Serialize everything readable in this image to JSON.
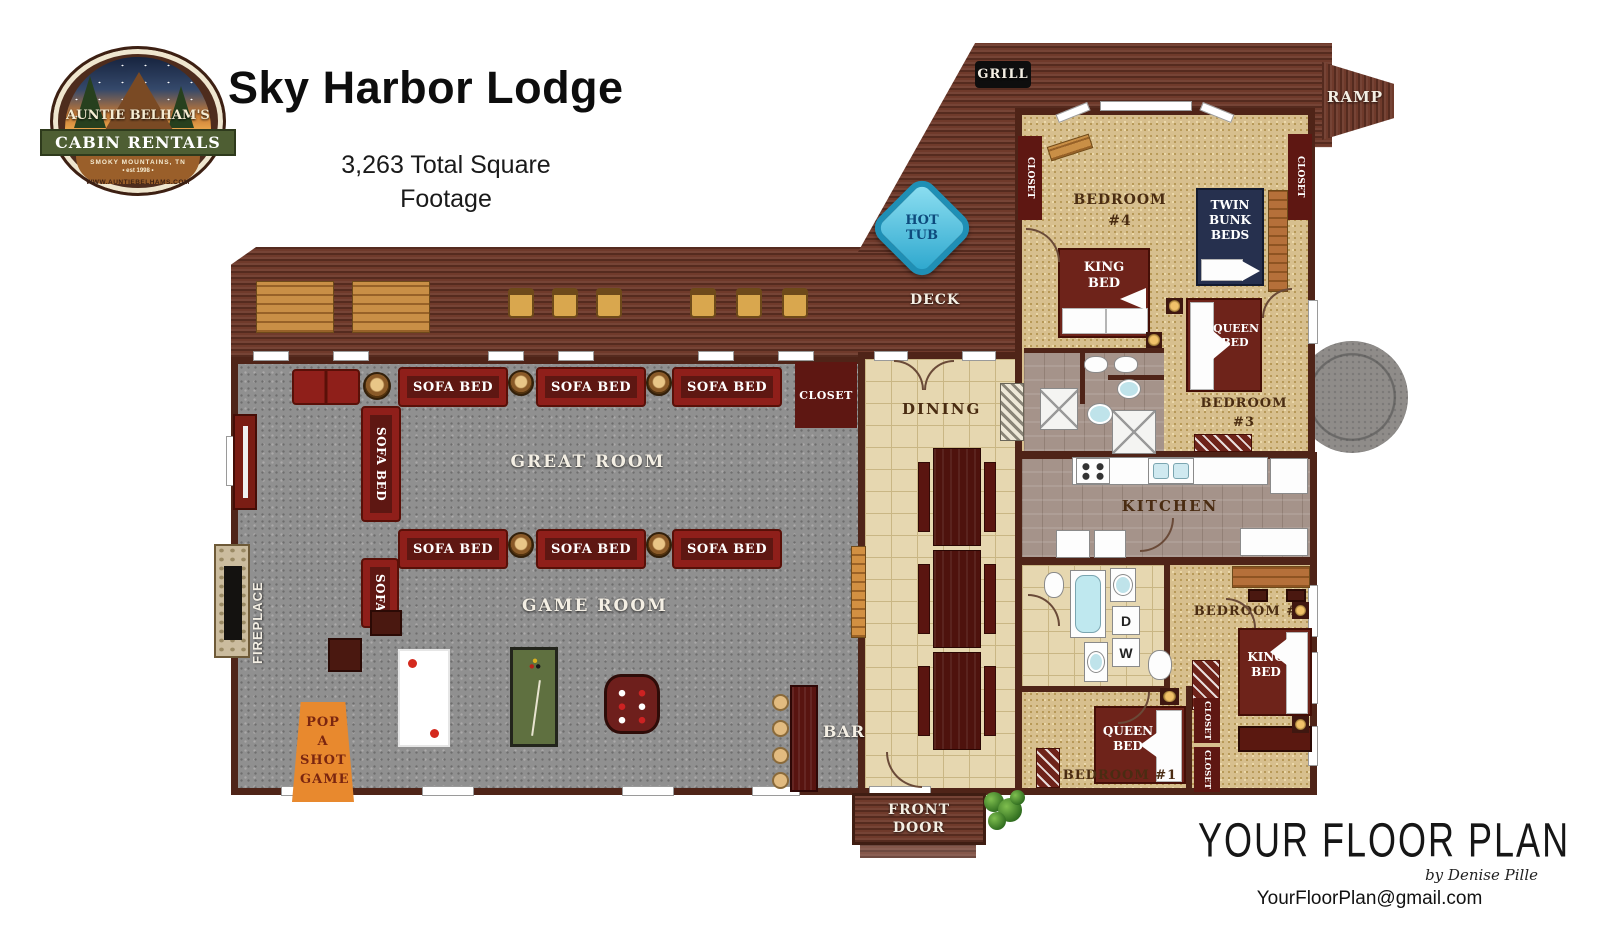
{
  "header": {
    "logo": {
      "arc_top": "AUNTIE BELHAM'S",
      "ribbon": "CABIN RENTALS",
      "sub_line": "SMOKY MOUNTAINS, TN",
      "est_line": "• est 1998 •",
      "arc_bottom": "WWW.AUNTIEBELHAMS.COM"
    },
    "title": "Sky Harbor Lodge",
    "sqft_line1": "3,263 Total Square",
    "sqft_line2": "Footage"
  },
  "deck": {
    "grill": "GRILL",
    "ramp": "RAMP",
    "hot_tub": "HOT TUB",
    "label": "DECK"
  },
  "great_room": {
    "label": "GREAT ROOM",
    "closet": "CLOSET",
    "fireplace": "FIREPLACE",
    "sofa_bed": "SOFA BED",
    "sofa": "SOFA"
  },
  "game_room": {
    "label": "GAME ROOM",
    "pop_a_shot": "POP A SHOT GAME",
    "bar": "BAR"
  },
  "dining": {
    "label": "DINING"
  },
  "kitchen": {
    "label": "KITCHEN"
  },
  "bedroom4": {
    "label": "BEDROOM #4",
    "king_bed": "KING BED",
    "bunk_beds": "TWIN BUNK BEDS",
    "closet_left": "CLOSET",
    "closet_right": "CLOSET"
  },
  "bedroom3": {
    "label": "BEDROOM #3",
    "queen_bed": "QUEEN BED"
  },
  "bedroom2": {
    "label": "BEDROOM #2",
    "king_bed": "KING BED"
  },
  "bedroom1": {
    "label": "BEDROOM #1",
    "queen_bed": "QUEEN BED",
    "closet_a": "CLOSET",
    "closet_b": "CLOSET"
  },
  "laundry": {
    "washer": "W",
    "dryer": "D"
  },
  "entry": {
    "front_door": "FRONT DOOR"
  },
  "footer": {
    "brand": "YOUR FLOOR PLAN",
    "byline": "by Denise Pille",
    "email": "YourFloorPlan@gmail.com"
  },
  "colors": {
    "wall": "#4f2418",
    "deck": "#6f3a2b",
    "carpet": "#909090",
    "bedroom_floor": "#d7bf8e",
    "tile": "#e6d7b0",
    "sofa_red": "#8f1f1a",
    "bed_maroon": "#6e231a",
    "bunk_navy": "#26304e",
    "hot_tub_blue": "#45c6e8",
    "pop_a_shot_orange": "#e8892e"
  }
}
